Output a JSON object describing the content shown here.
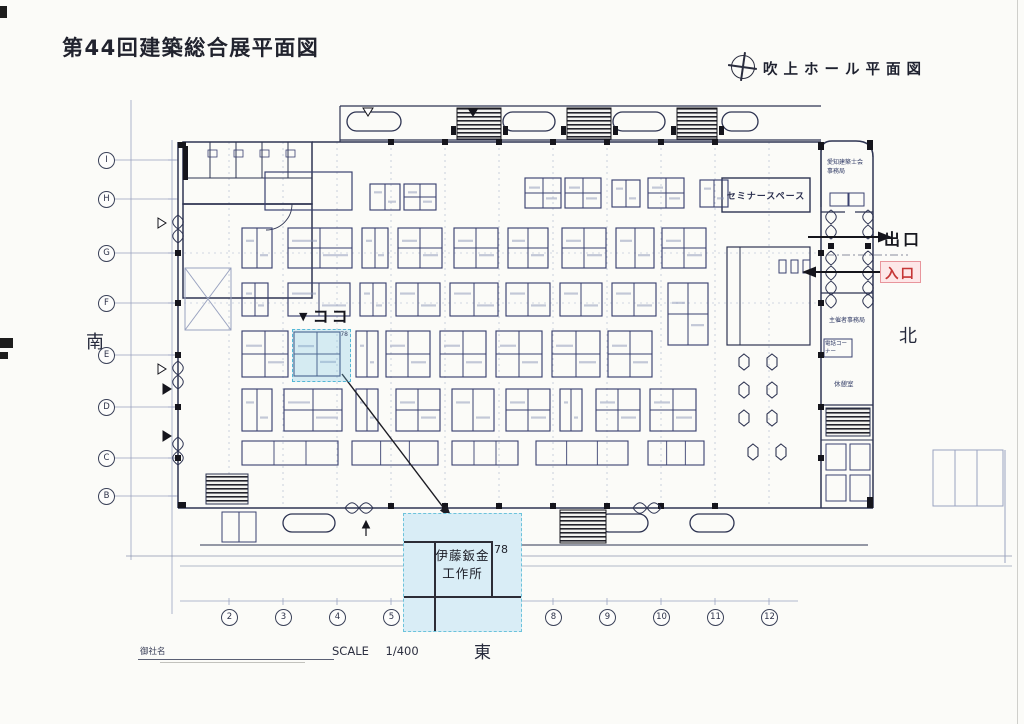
{
  "header": {
    "title": "第44回建築総合展平面図",
    "hall_plan_label": "吹上ホール平面図",
    "compass_icon": "circle-crosshair"
  },
  "directions": {
    "south": "南",
    "north": "北",
    "east": "東"
  },
  "entry": {
    "exit_label": "出口",
    "entrance_label": "入口"
  },
  "here_marker": {
    "triangle": "▼",
    "label": "ココ"
  },
  "booth": {
    "number": "78",
    "name_line1": "伊藤鈑金",
    "name_line2": "工作所",
    "highlight_fill": "#d9edf6",
    "highlight_border": "#6cc3db"
  },
  "rooms": {
    "seminar_space": "セミナースペース",
    "organizer_office": "主催者事務局",
    "association_office_line1": "愛知建築士会",
    "association_office_line2": "事務局",
    "phone_corner": "電話コーナー",
    "lounge": "休憩室"
  },
  "grid": {
    "row_labels": [
      "I",
      "H",
      "G",
      "F",
      "E",
      "D",
      "C",
      "B"
    ],
    "col_labels": [
      "2",
      "3",
      "4",
      "5",
      "8",
      "9",
      "10",
      "11",
      "12"
    ]
  },
  "footer": {
    "company_name_label": "御社名",
    "scale_label": "SCALE",
    "scale_value": "1/400"
  },
  "colors": {
    "plan_line": "#2e3452",
    "booth_line": "#3a4170",
    "accent_red": "#c53636",
    "entrance_bg": "#fde7e8",
    "highlight_cyan": "#bfe2ef"
  }
}
